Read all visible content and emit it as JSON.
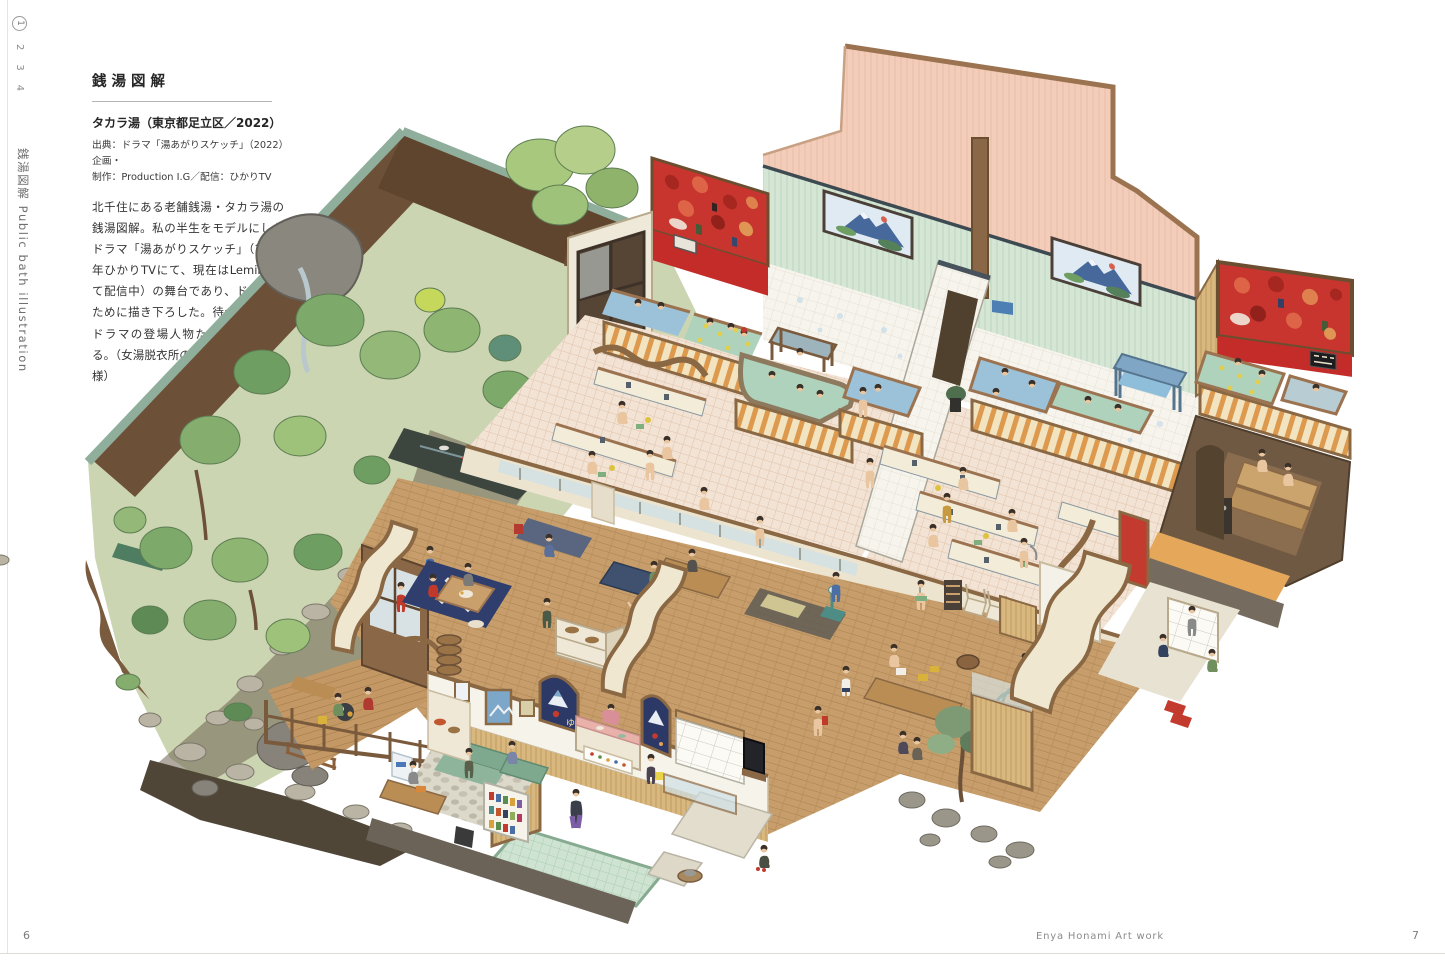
{
  "page": {
    "side_nav": {
      "items": [
        "1",
        "2",
        "3",
        "4"
      ],
      "current": "1"
    },
    "side_title": "銭湯図解 Public bath illustration",
    "article": {
      "title": "銭湯図解",
      "subtitle": "タカラ湯（東京都足立区／2022）",
      "credit_line1": "出典：ドラマ「湯あがりスケッチ」（2022）　企画・",
      "credit_line2": "制作：Production I.G／配信：ひかりTV",
      "body": "北千住にある老舗銭湯・タカラ湯の銭湯図解。私の半生をモデルにしたドラマ「湯あがりスケッチ」（2022年ひかりTVにて、現在はLeminoにて配信中）の舞台であり、ドラマのために描き下ろした。待合室などにドラマの登場人物たちを描いている。（女湯脱衣所のこたつはドラマ仕様）"
    },
    "footer": {
      "page_left": "6",
      "credit": "Enya Honami Art work",
      "page_right": "7"
    }
  },
  "illustration": {
    "alt": "タカラ湯の銭湯をカットモデルで俯瞰した水彩図解（庭園・女湯・男湯・サウナ・脱衣所・番台・玄関）",
    "noren_character": "ゆ",
    "palette": {
      "pink_wall": "#f3cdb9",
      "green_wall": "#d5e6d5",
      "red_mural": "#c8352e",
      "red_band": "#c32c28",
      "white_tile": "#f6f4ed",
      "water_blue": "#9cc2d9",
      "water_green": "#aed2bc",
      "yuzu_yellow": "#e3cf4b",
      "tile_floor": "#f2e3d4",
      "wood_floor": "#c79e6b",
      "trim_brown": "#8a6844",
      "genkan_green": "#cfe3d2",
      "sauna_floor": "#e5a75a",
      "noren_navy": "#2c3966",
      "garden_green": "#8fb573",
      "rock_gray": "#9b968a"
    }
  }
}
